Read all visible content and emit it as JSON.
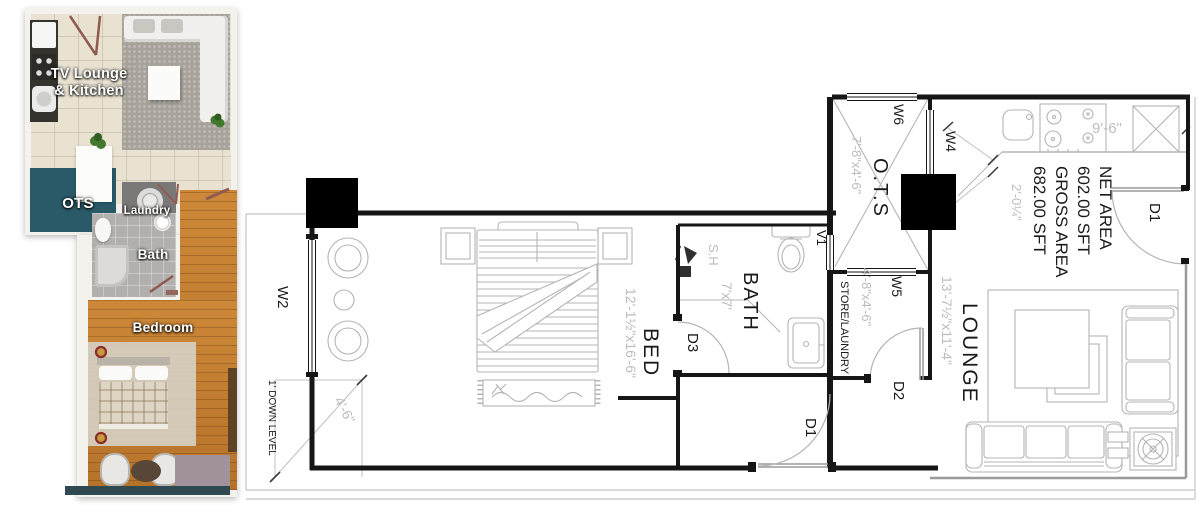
{
  "colors": {
    "wall": "#161616",
    "line_gray": "#b5b5b5",
    "dim_text": "#bdbdbd",
    "label": "#1a1a1a",
    "redaction": "#000000",
    "ots_teal": "#2a5a68",
    "wood": "#c07a2e",
    "tile_beige": "#eae2d1",
    "rug_gray": "#a7a29a",
    "bath_gray": "#b2b0ae",
    "laundry_gray": "#7b7977",
    "maroon": "#8f5b50"
  },
  "rendered_plan": {
    "labels": {
      "lounge_line1": "TV Lounge",
      "lounge_line2": "& Kitchen",
      "ots": "OTS",
      "laundry": "Laundry",
      "bath": "Bath",
      "bedroom": "Bedroom"
    }
  },
  "cad_plan": {
    "area_summary": {
      "line1": "NET AREA",
      "line2": "602.00 SFT",
      "line3": "GROSS AREA",
      "line4": "682.00 SFT"
    },
    "rooms": {
      "ots": {
        "name": "O.T.S",
        "dim": "7'-8\"x4'-6\""
      },
      "bath": {
        "name": "BATH",
        "dim": "7'x7'",
        "shower": "S.H"
      },
      "bed": {
        "name": "BED",
        "dim": "12'-1½\"x16'-6\""
      },
      "store": {
        "name": "STORE/LAUNDRY",
        "dim": "4'-8\"x4'-6\""
      },
      "lounge": {
        "name": "LOUNGE",
        "dim": "13'-7½\"x11'-4\""
      }
    },
    "dims": {
      "kitchen_counter": "9'-6\"",
      "counter_depth": "2'-0¼\"",
      "balcony": "4'-6\""
    },
    "openings": {
      "w2": "W2",
      "w4": "W4",
      "w5": "W5",
      "w6": "W6",
      "v1": "V1",
      "d1": "D1",
      "d2": "D2",
      "d3": "D3"
    },
    "notes": {
      "down_level": "1' DOWN LEVEL"
    }
  }
}
